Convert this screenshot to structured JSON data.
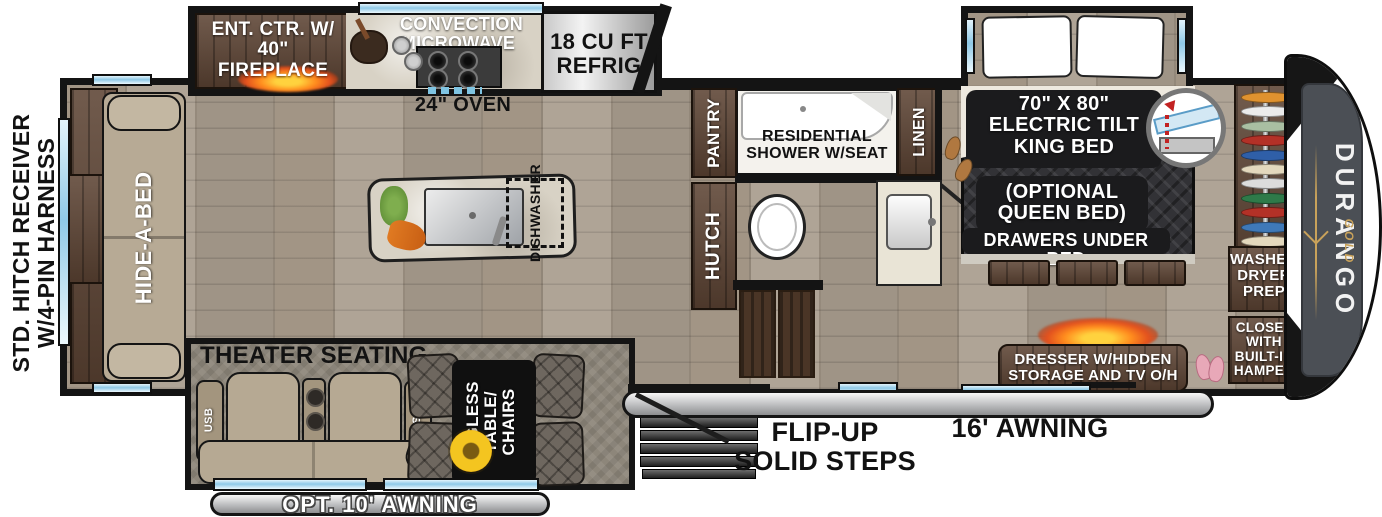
{
  "labels": {
    "hitch": "STD. HITCH RECEIVER\nW/4-PIN HARNESS",
    "ent_ctr": "ENT. CTR. W/\n40\" FIREPLACE",
    "microwave": "CONVECTION\nMICROWAVE",
    "oven": "24\" OVEN",
    "refrig": "18 CU FT\nREFRIG",
    "pantry": "PANTRY",
    "shower": "RESIDENTIAL\nSHOWER W/SEAT",
    "linen": "LINEN",
    "hutch": "HUTCH",
    "hide_a_bed": "HIDE-A-BED",
    "dishwasher": "DISHWASHER",
    "bed": "70\" X 80\"\nELECTRIC TILT\nKING BED",
    "bed_optional": "(OPTIONAL\nQUEEN BED)",
    "bed_drawers": "DRAWERS UNDER BED",
    "washer_dryer": "WASHER/\nDRYER\nPREP",
    "closet": "CLOSET\nWITH\nBUILT-IN\nHAMPER",
    "dresser": "DRESSER W/HIDDEN\nSTORAGE AND TV O/H",
    "theater": "THEATER SEATING",
    "usb": "USB",
    "legless": "LEGLESS\nTABLE/\nCHAIRS",
    "steps": "FLIP-UP\nSOLID STEPS",
    "awning_16": "16' AWNING",
    "awning_10": "OPT. 10' AWNING",
    "brand": "DURANGO",
    "brand_sub": "GOLD"
  },
  "closet_hangers": {
    "colors": [
      "#e0922f",
      "#ebebeb",
      "#a9bfa2",
      "#b33127",
      "#2f5fa8",
      "#e3d8bd",
      "#dcdcdc",
      "#2e7a49",
      "#b33127",
      "#3f79b8",
      "#e3d8bd",
      "#ebebeb",
      "#9cc49a"
    ]
  },
  "colors": {
    "wall": "#141414",
    "window_glass": "#8fc9e7",
    "wood_floor": "#a99d8e",
    "cabinet_wood": "#5d4434",
    "fire_glow": "#ff8c1e",
    "awning_silver": "#bcbdbf",
    "brand_gold": "#c9a25a"
  }
}
